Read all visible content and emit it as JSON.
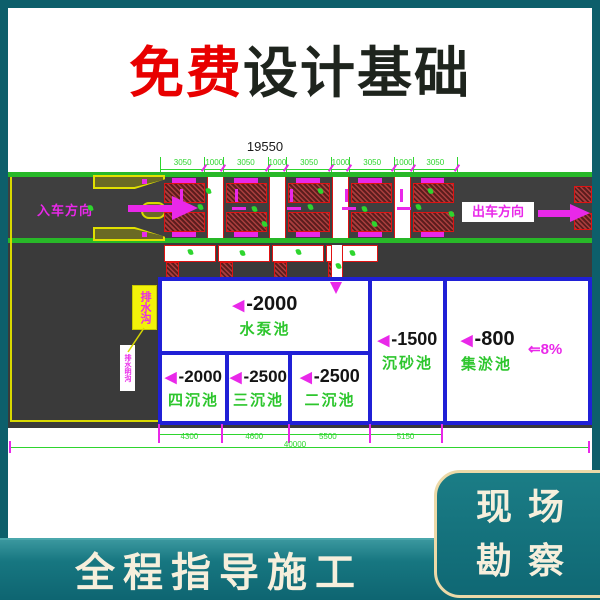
{
  "title": {
    "free": "免费",
    "rest": "设计基础"
  },
  "drawing": {
    "marker": "◀",
    "top_dimension": {
      "total": "19550",
      "segments": [
        "3050",
        "1000",
        "3050",
        "1000",
        "3050",
        "1000",
        "3050",
        "1000",
        "3050"
      ]
    },
    "road": {
      "entry_label": "入车方向",
      "exit_label": "出车方向"
    },
    "callouts": {
      "boxed_note": "排水沟",
      "small_note": "排水明沟"
    },
    "pools": [
      {
        "depth": "-2000",
        "name": "水泵池"
      },
      {
        "depth": "-2000",
        "name": "四沉池"
      },
      {
        "depth": "-2500",
        "name": "三沉池"
      },
      {
        "depth": "-2500",
        "name": "二沉池"
      },
      {
        "depth": "-1500",
        "name": "沉砂池"
      },
      {
        "depth": "-800",
        "name": "集淤池"
      }
    ],
    "slope_label": "⇐8%",
    "bottom_dimension": {
      "segments": [
        "4300",
        "4600",
        "5500",
        "5150"
      ],
      "total": "40000"
    }
  },
  "footer": {
    "banner": "全程指导施工",
    "badge_line1": "现场",
    "badge_line2": "勘察"
  },
  "colors": {
    "background_teal": "#0d5f6b",
    "accent_red": "#e80000",
    "cad_magenta": "#e928e9",
    "cad_green": "#2ed52e",
    "pool_blue": "#2020d6",
    "hatch_red": "#e01212",
    "banner_cream": "#f6efdc"
  }
}
